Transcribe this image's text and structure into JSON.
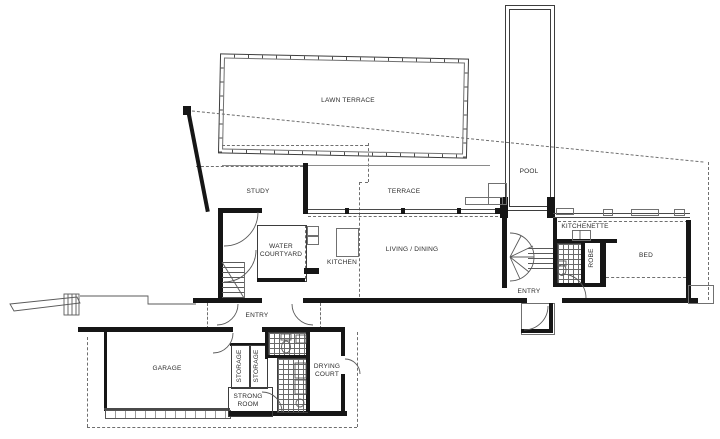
{
  "drawing": {
    "type": "architectural floor plan",
    "rooms": {
      "lawn_terrace": "LAWN TERRACE",
      "pool": "POOL",
      "study": "STUDY",
      "terrace": "TERRACE",
      "water_courtyard": "WATER COURTYARD",
      "kitchen": "KITCHEN",
      "living_dining": "LIVING / DINING",
      "kitchenette": "KITCHENETTE",
      "robe": "ROBE",
      "bed": "BED",
      "entry_main": "ENTRY",
      "entry_lower": "ENTRY",
      "garage": "GARAGE",
      "storage_left": "STORAGE",
      "storage_right": "STORAGE",
      "strong_room": "STRONG ROOM",
      "drying_court": "DRYING COURT"
    },
    "colors": {
      "background": "#ffffff",
      "wall": "#161616",
      "thin_line": "#4a4a4a",
      "dashed_line": "#6f6f6f",
      "text": "#2b2b2b"
    }
  }
}
